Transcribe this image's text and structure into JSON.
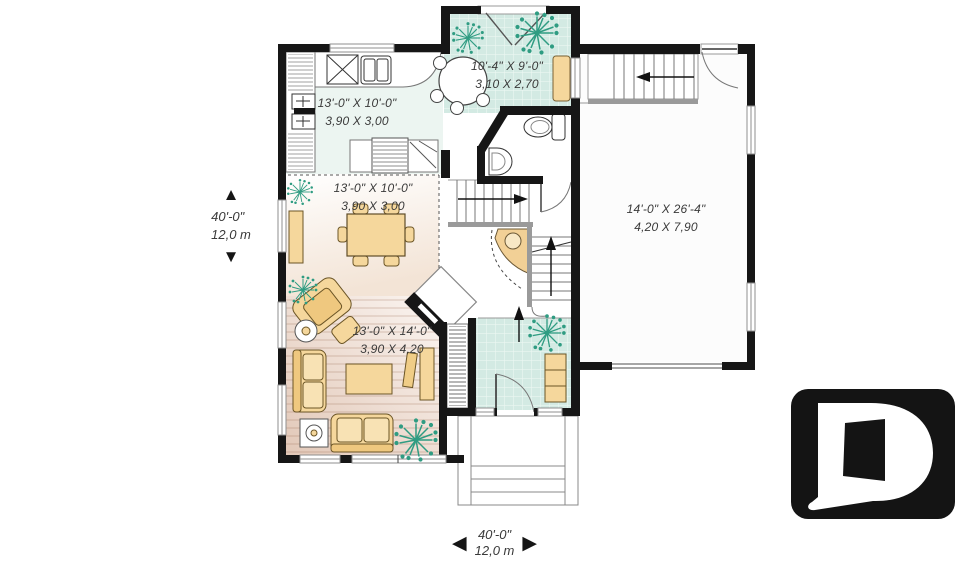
{
  "rooms": {
    "nook": {
      "imperial": "10'-4\" X 9'-0\"",
      "metric": "3,10 X 2,70"
    },
    "kitchen": {
      "imperial": "13'-0\" X 10'-0\"",
      "metric": "3,90 X 3,00"
    },
    "dining": {
      "imperial": "13'-0\" X 10'-0\"",
      "metric": "3,90 X 3,00"
    },
    "living": {
      "imperial": "13'-0\" X 14'-0\"",
      "metric": "3,90 X 4,20"
    },
    "garage": {
      "imperial": "14'-0\" X 26'-4\"",
      "metric": "4,20 X 7,90"
    }
  },
  "dimensions": {
    "depth": {
      "imperial": "40'-0\"",
      "metric": "12,0 m"
    },
    "width": {
      "imperial": "40'-0\"",
      "metric": "12,0 m"
    }
  },
  "arrows": {
    "up": "▲",
    "down": "▼",
    "left": "◀",
    "right": "▶"
  },
  "logo": {
    "letter": "D"
  },
  "colors": {
    "wall": "#161616",
    "tile_floor": "#d3eae3",
    "wood_floor": "#e3cabb",
    "furniture": "#f5d79c",
    "plant": "#2f9c82"
  }
}
